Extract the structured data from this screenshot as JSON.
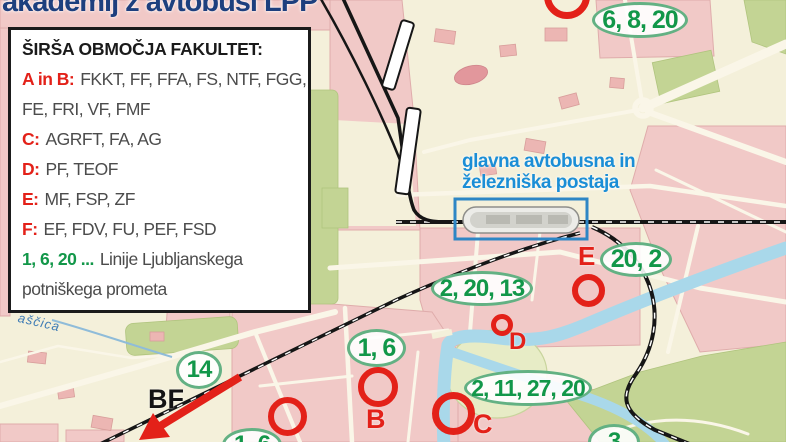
{
  "title": "akademij z avtobusi LPP",
  "colors": {
    "title_navy": "#1d3f7e",
    "zone_red": "#e32119",
    "lpp_green": "#129749",
    "badge_border_green": "#63b183",
    "station_label_blue": "#1b8ed6",
    "station_box_blue": "#2e86c5",
    "map_background_cream": "#f4f0da",
    "block_pink": "#f1c9c7",
    "park_green": "#c3d494",
    "river_blue": "#a9d8ea",
    "railway_black": "#161616"
  },
  "legend": {
    "heading": "ŠIRŠA OBMOČJA FAKULTET:",
    "lines": [
      {
        "lead": "A in B:",
        "rest": "FKKT, FF, FFA, FS, NTF, FGG,"
      },
      {
        "lead": "",
        "rest": "FE, FRI, VF, FMF"
      },
      {
        "lead": "C:",
        "rest": "AGRFT, FA, AG"
      },
      {
        "lead": "D:",
        "rest": "PF, TEOF"
      },
      {
        "lead": "E:",
        "rest": "MF, FSP, ZF"
      },
      {
        "lead": "F:",
        "rest": "EF, FDV, FU, PEF, FSD"
      },
      {
        "lead": "1, 6, 20 ...",
        "rest": "Linije Ljubljanskega"
      },
      {
        "lead": "",
        "rest": "potniškega prometa"
      }
    ]
  },
  "station": {
    "label_line1": "glavna avtobusna in",
    "label_line2": "železniška postaja"
  },
  "map": {
    "badges": [
      {
        "text": "6, 8, 20"
      },
      {
        "text": "20, 2"
      },
      {
        "text": "2, 20, 13"
      },
      {
        "text": "1, 6"
      },
      {
        "text": "2, 11, 27, 20"
      },
      {
        "text": "14"
      },
      {
        "text": "1, 6"
      },
      {
        "text": "3"
      }
    ],
    "markers": [
      {
        "letter": "E"
      },
      {
        "letter": "D"
      },
      {
        "letter": "B"
      },
      {
        "letter": "C"
      }
    ],
    "bf_label": "BF",
    "stream_label": "aščica"
  }
}
